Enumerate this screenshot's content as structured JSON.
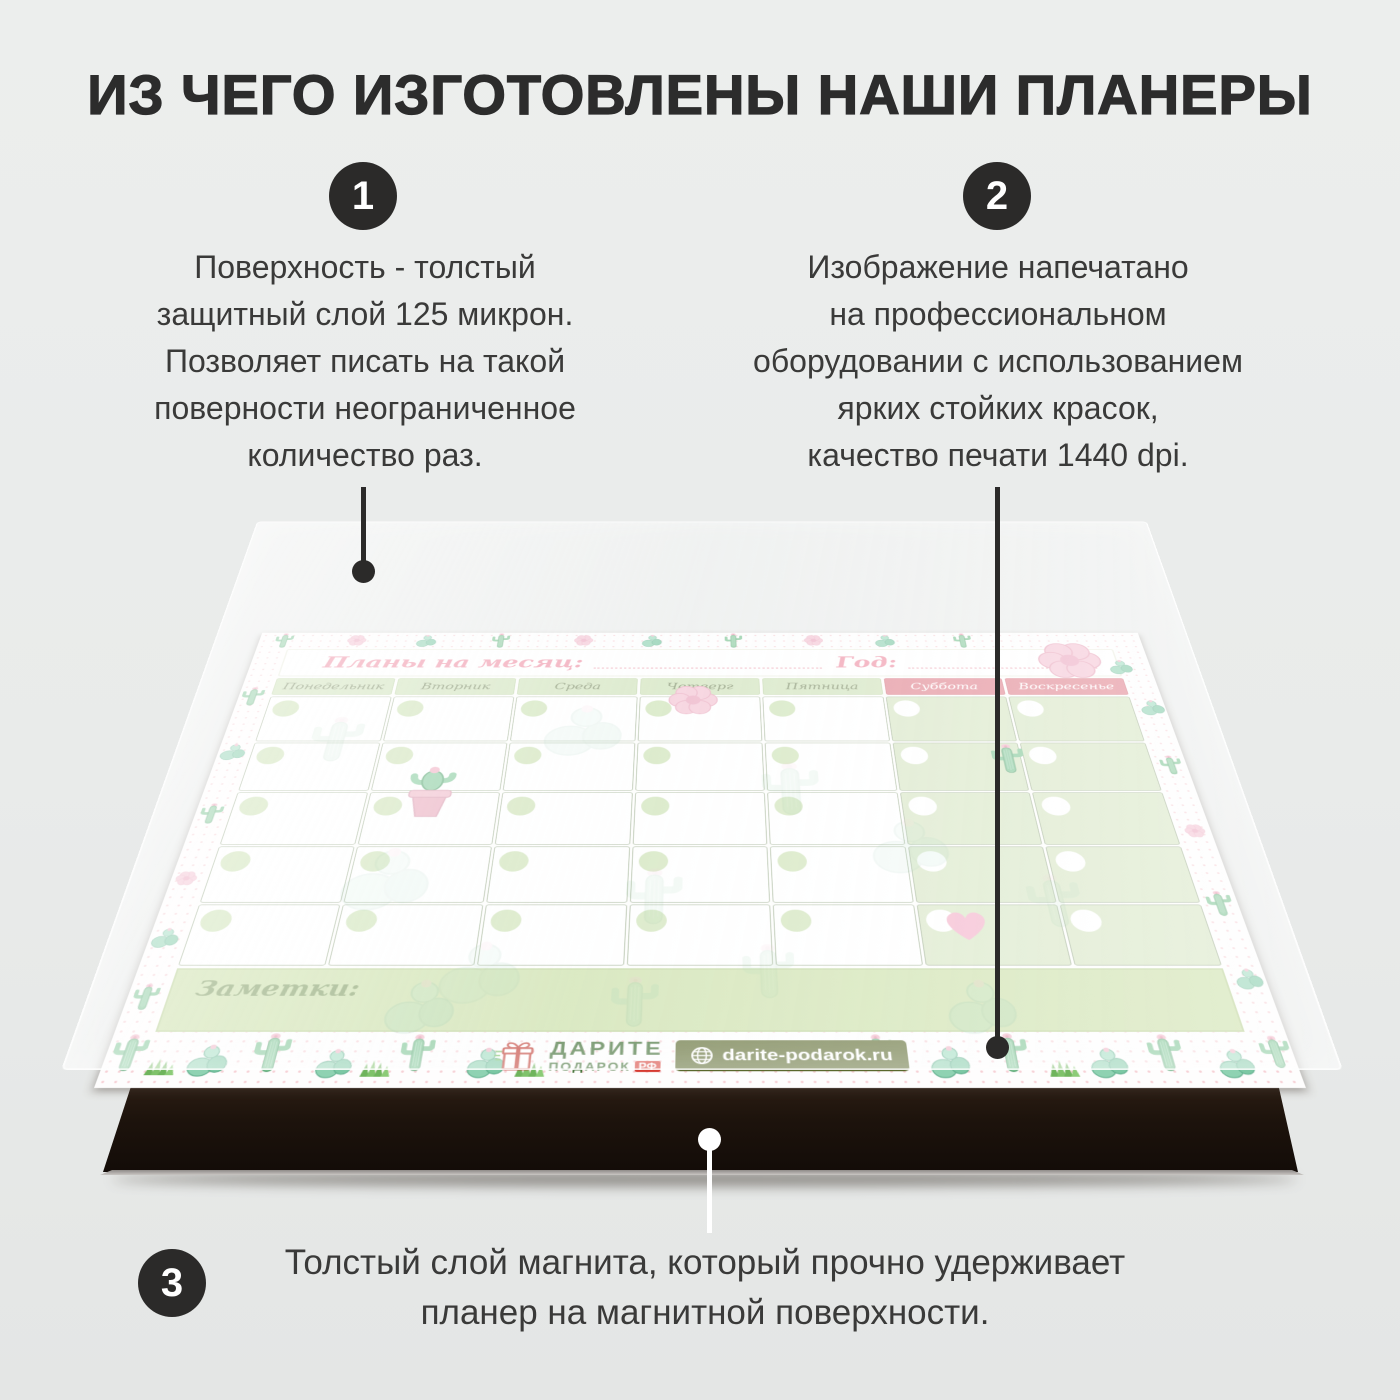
{
  "title": "ИЗ ЧЕГО ИЗГОТОВЛЕНЫ НАШИ ПЛАНЕРЫ",
  "points": [
    {
      "number": "1",
      "lines": [
        "Поверхность - толстый",
        "защитный слой 125 микрон.",
        "Позволяет писать на такой",
        "поверности неограниченное",
        "количество раз."
      ]
    },
    {
      "number": "2",
      "lines": [
        "Изображение напечатано",
        "на профессиональном",
        "оборудовании с использованием",
        "ярких стойких красок,",
        "качество печати 1440 dpi."
      ]
    },
    {
      "number": "3",
      "lines": [
        "Толстый слой магнита, который прочно удерживает",
        "планер на магнитной поверхности."
      ]
    }
  ],
  "planner": {
    "month_label": "Планы на месяц:",
    "year_label": "Год:",
    "weekdays": [
      "Понедельник",
      "Вторник",
      "Среда",
      "Четверг",
      "Пятница",
      "Суббота",
      "Воскресенье"
    ],
    "notes_label": "Заметки:",
    "logo": {
      "brand_top": "ДАРИТЕ",
      "brand_bottom": "ПОДАРОК",
      "brand_suffix": "РФ",
      "website": "darite-podarok.ru"
    }
  },
  "colors": {
    "background_gray": "#e9ebea",
    "ink_dark": "#2b2a29",
    "weekday_green": "#cfe2b9",
    "weekend_pink": "#e0818d",
    "notes_green": "#cadfa6",
    "label_pink": "#ef8fa4",
    "magnet_dark": "#1d130c",
    "badge_olive": "#5a682c",
    "brand_green": "#3a6a2e",
    "brand_red": "#d63a31"
  }
}
